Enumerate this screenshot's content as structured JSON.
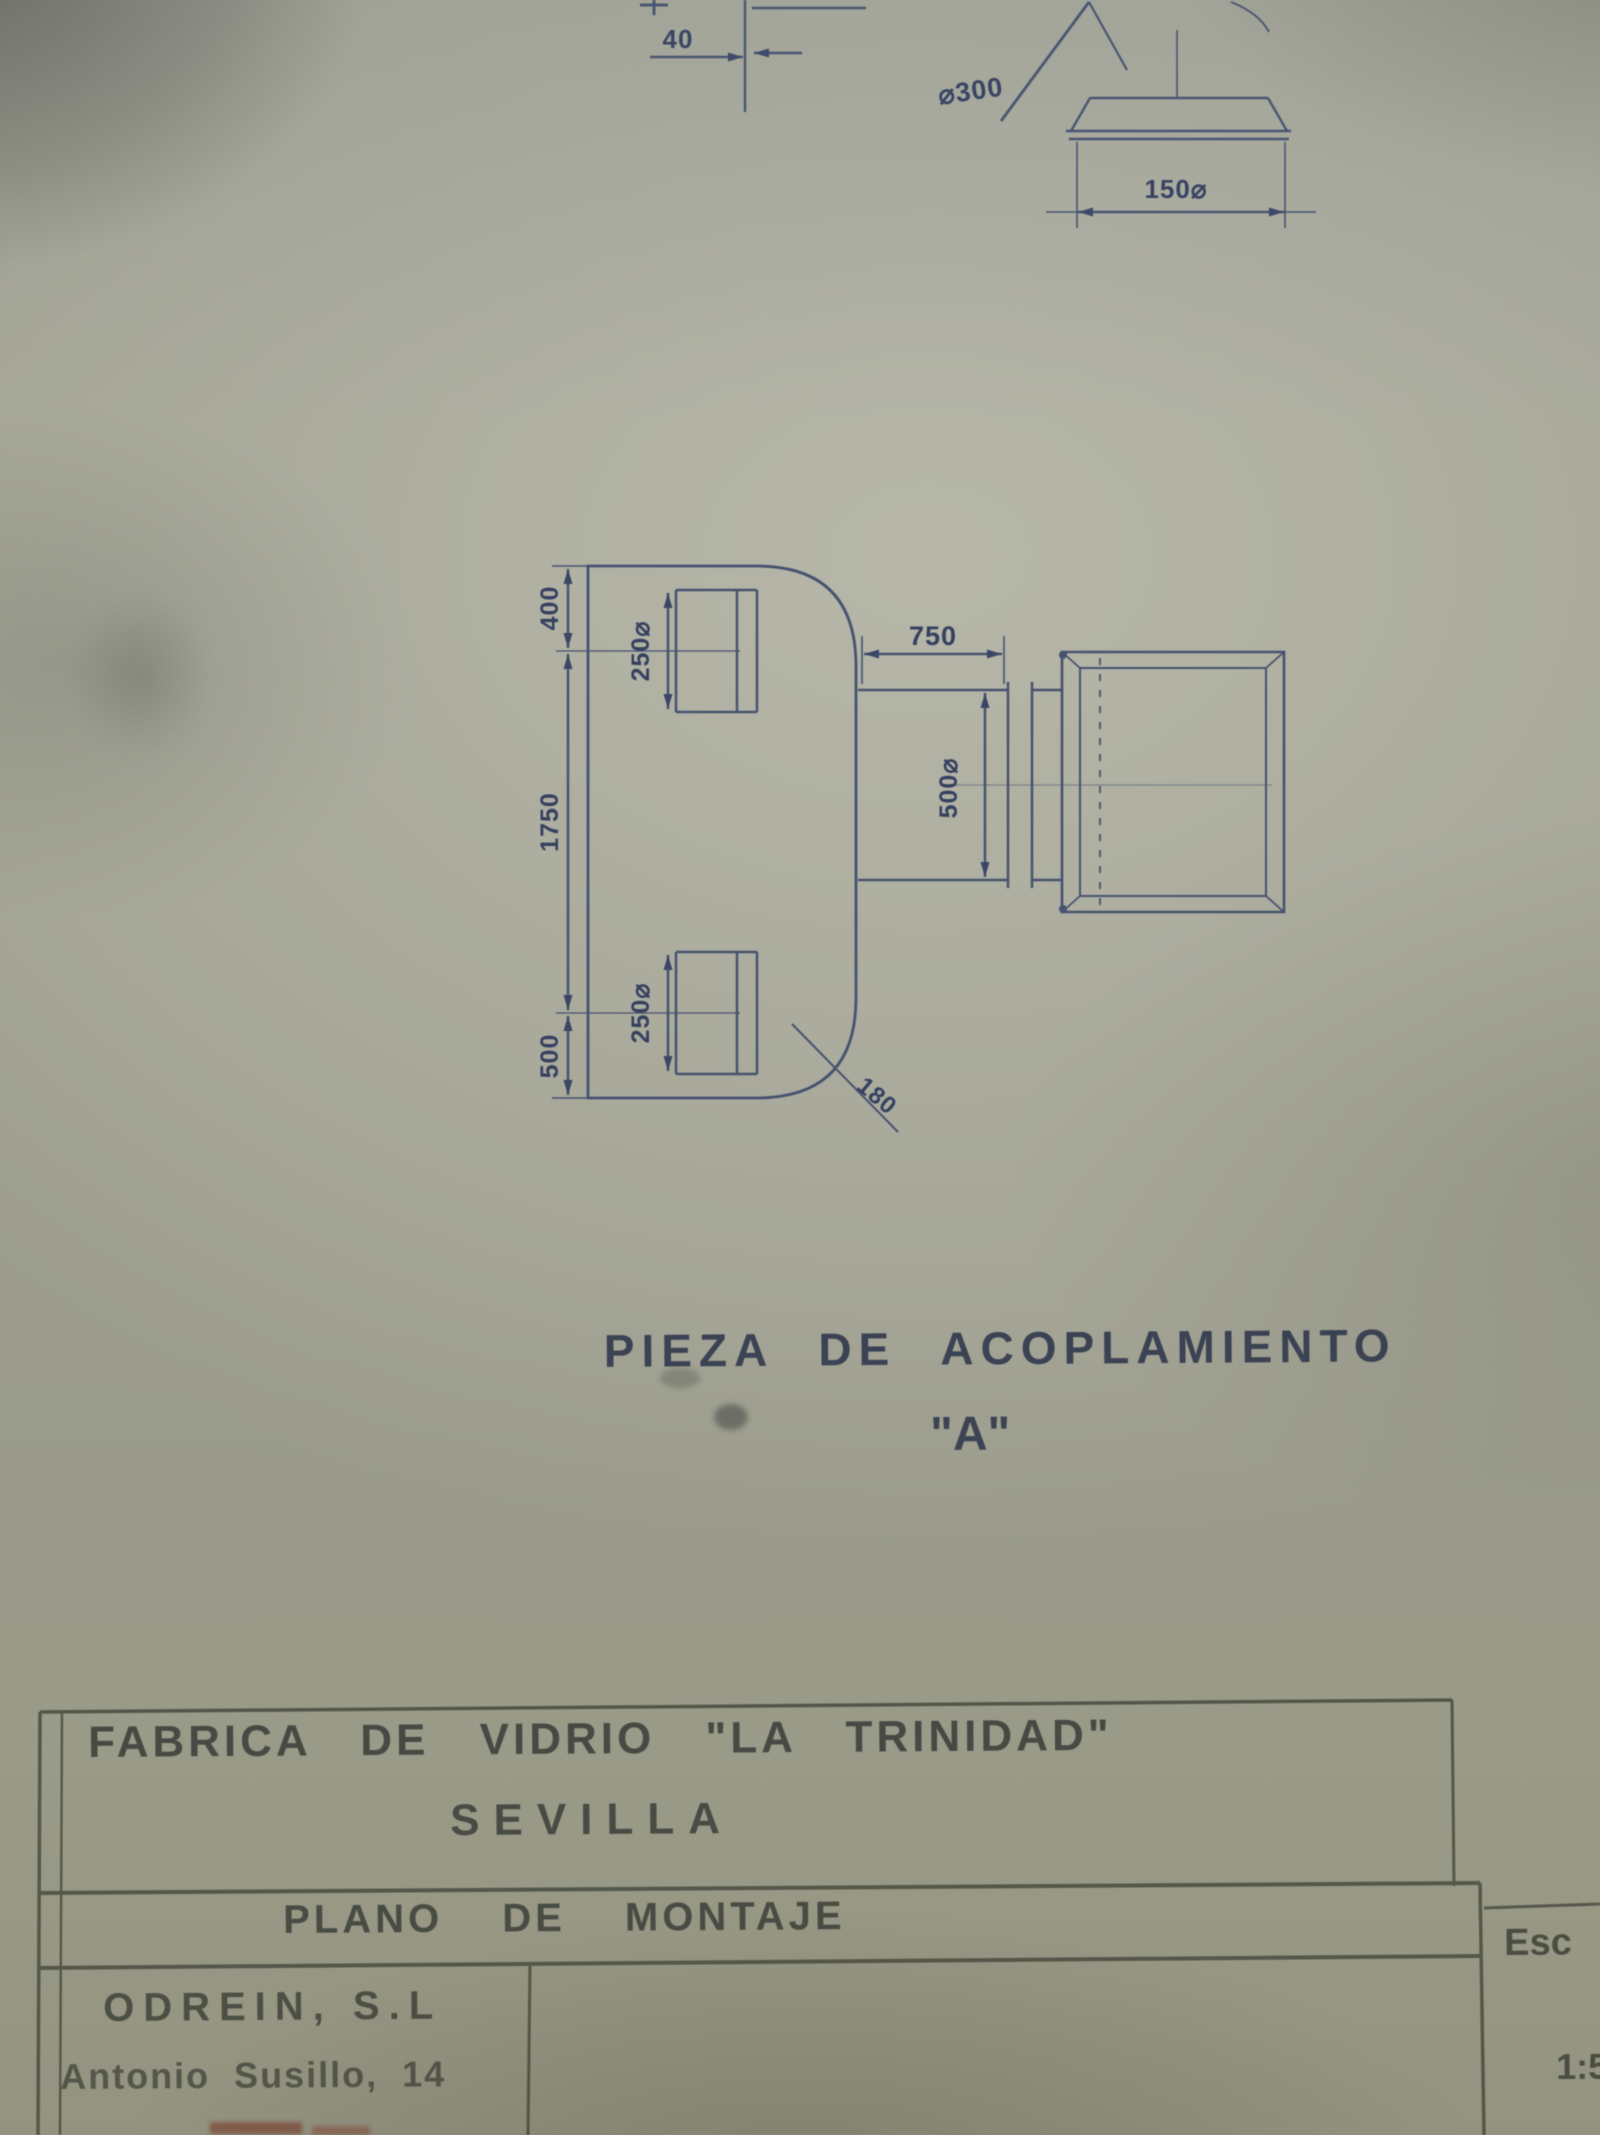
{
  "colors": {
    "paper": "#adaea0",
    "drawing_ink": "#46526f",
    "dimension_ink": "#354060",
    "titleblock_ink": "#3d423f",
    "stamp_red": "#7e3a2e"
  },
  "top_fragment": {
    "dim_gap": "40",
    "dim_cone": "⌀300",
    "dim_base": "150⌀"
  },
  "main": {
    "caption": "PIEZA DE ACOPLAMIENTO",
    "caption_variant": "\"A\"",
    "dims": {
      "left_top": "400",
      "left_mid": "1750",
      "left_bottom": "500",
      "flange_top": "250⌀",
      "flange_bottom": "250⌀",
      "neck_length": "750",
      "neck_diameter": "500⌀",
      "chamfer": "180"
    }
  },
  "title_block": {
    "company": "FABRICA DE VIDRIO \"LA TRINIDAD\"",
    "city": "SEVILLA",
    "drawing_title": "PLANO DE MONTAJE",
    "firm": "ODREIN, S.L",
    "address": "Antonio Susillo, 14",
    "scale_label": "Esc",
    "scale_value": "1:5"
  }
}
